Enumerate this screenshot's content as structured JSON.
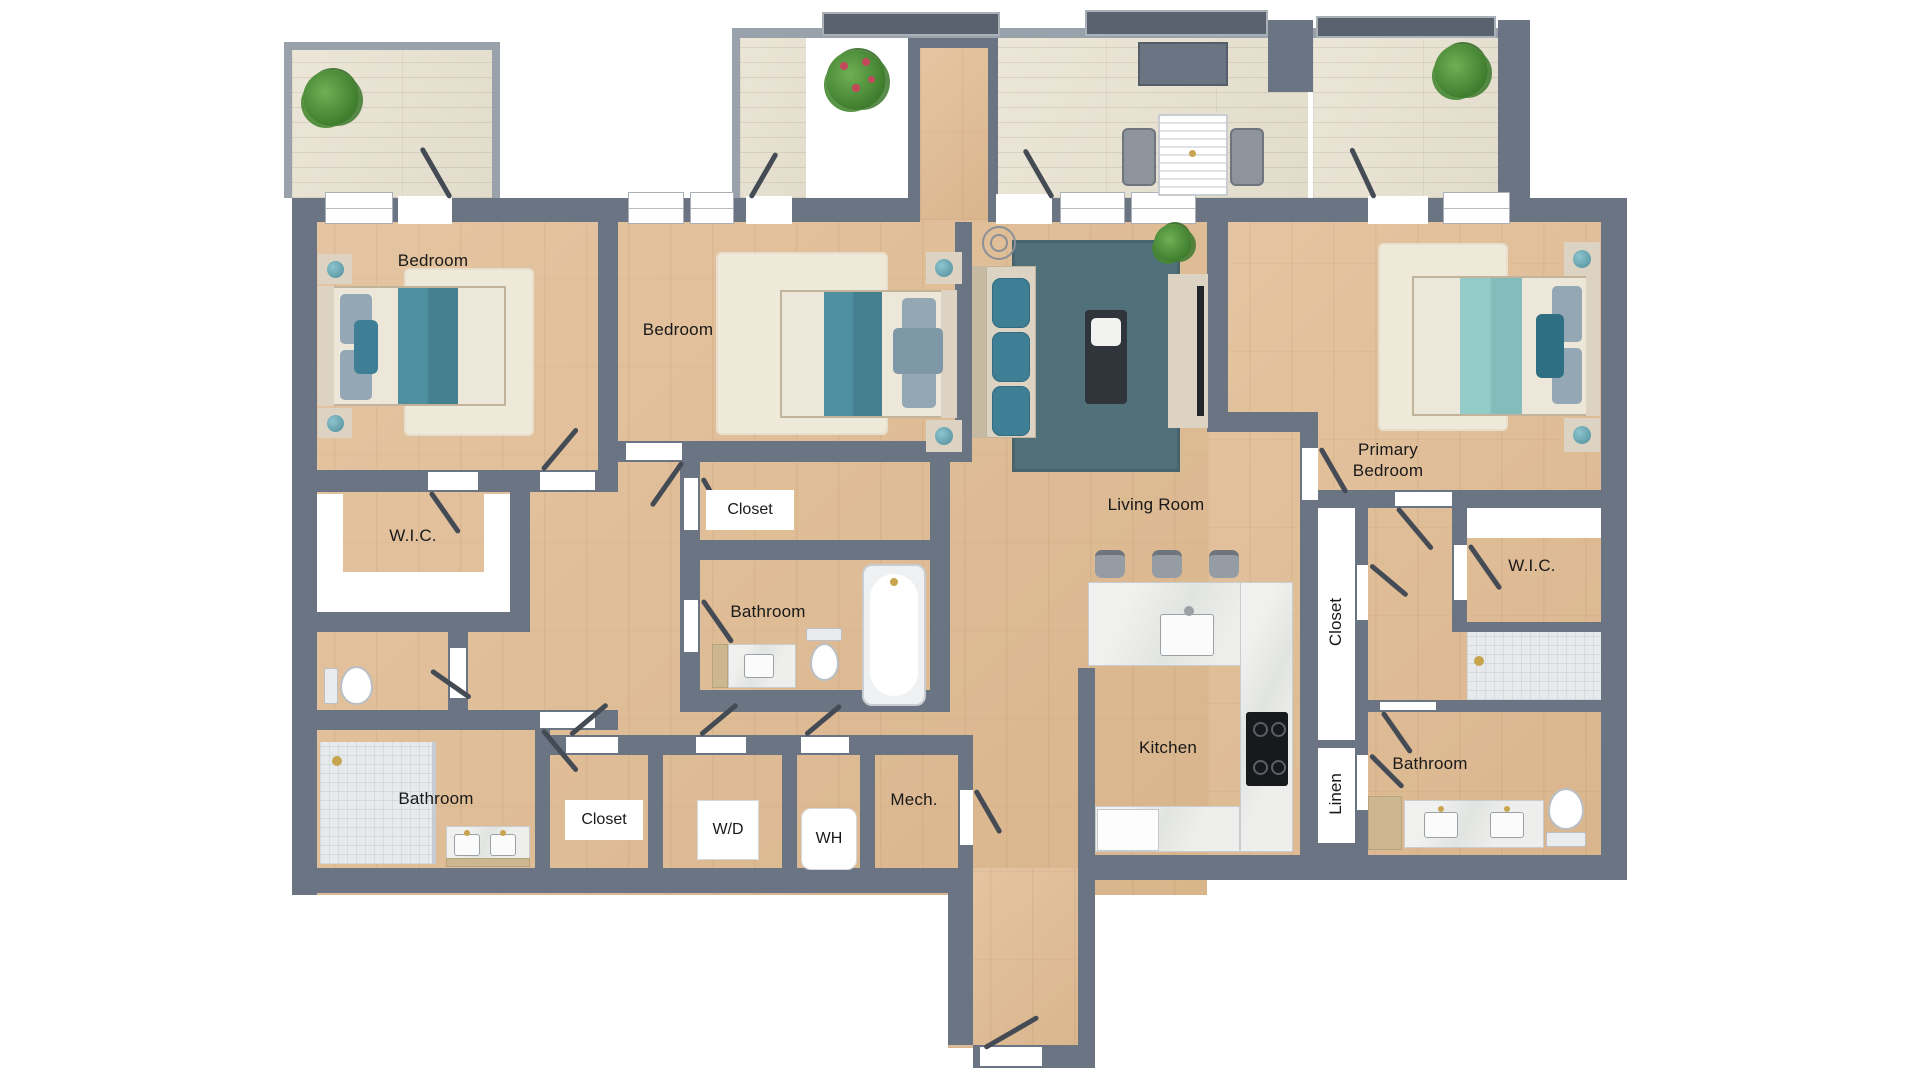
{
  "plan_title": "Residential floor plan – 3 bedroom apartment",
  "palette": {
    "wall": "#6b7482",
    "wall_light": "#99a1ab",
    "wood_floor": "#ddbb95",
    "deck_floor": "#e8e2d3",
    "tile": "#e6eaec",
    "rug_cream": "#efe9da",
    "rug_dark_teal": "#50707a",
    "bedding_teal": "#4e8fa0",
    "bedding_aqua": "#92cbc7",
    "accent_dark_teal": "#2e6f83",
    "furniture_beige": "#dcd3c2",
    "marble": "#eceeec",
    "cabinet_wood": "#cdb791",
    "gold_fixture": "#c8a44e",
    "plant_green": "#4c943b",
    "door_leaf": "#454b54"
  },
  "rooms": [
    {
      "id": "bedroom-1",
      "label": "Bedroom"
    },
    {
      "id": "bedroom-2",
      "label": "Bedroom"
    },
    {
      "id": "primary-bedroom",
      "label": "Primary Bedroom"
    },
    {
      "id": "living-room",
      "label": "Living Room"
    },
    {
      "id": "kitchen",
      "label": "Kitchen"
    },
    {
      "id": "wic-left",
      "label": "W.I.C."
    },
    {
      "id": "wic-primary",
      "label": "W.I.C."
    },
    {
      "id": "bathroom-middle",
      "label": "Bathroom"
    },
    {
      "id": "bathroom-left",
      "label": "Bathroom"
    },
    {
      "id": "bathroom-primary",
      "label": "Bathroom"
    },
    {
      "id": "closet-bedroom2",
      "label": "Closet"
    },
    {
      "id": "closet-hall",
      "label": "Closet"
    },
    {
      "id": "washer-dryer",
      "label": "W/D"
    },
    {
      "id": "water-heater",
      "label": "WH"
    },
    {
      "id": "mechanical",
      "label": "Mech."
    },
    {
      "id": "closet-primary",
      "label": "Closet"
    },
    {
      "id": "linen",
      "label": "Linen"
    }
  ]
}
